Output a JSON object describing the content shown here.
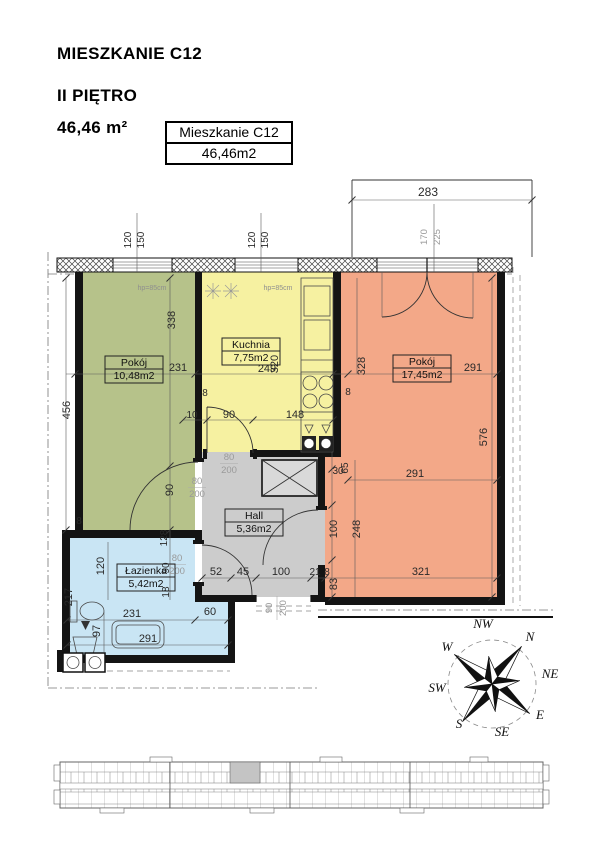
{
  "header": {
    "title": "MIESZKANIE C12",
    "floor": "II PIĘTRO",
    "area": "46,46 m²"
  },
  "label_box": {
    "name": "Mieszkanie C12",
    "area": "46,46m2"
  },
  "rooms": {
    "green": {
      "name": "Pokój",
      "area": "10,48m2"
    },
    "kitchen": {
      "name": "Kuchnia",
      "area": "7,75m2"
    },
    "living": {
      "name": "Pokój",
      "area": "17,45m2"
    },
    "hall": {
      "name": "Hall",
      "area": "5,36m2"
    },
    "bath": {
      "name": "Łazienka",
      "area": "5,42m2"
    }
  },
  "colors": {
    "green": "#b6c28a",
    "kitchen": "#f6f1a1",
    "living": "#f3a888",
    "hall": "#cccccc",
    "bath": "#c9e5f4"
  },
  "dims": {
    "d283": "283",
    "d170": "170",
    "d225": "225",
    "d120": "120",
    "d150": "150",
    "hp": "hp=85cm",
    "g338": "338",
    "g231": "231",
    "g456": "456",
    "g8": "8",
    "gdoor90": "90",
    "c128": "128",
    "c90": "90",
    "c18": "18",
    "k249": "249",
    "k320": "320",
    "k8": "8",
    "k10": "10",
    "k90": "90",
    "k148": "148",
    "o328": "328",
    "o8": "8",
    "o291a": "291",
    "o291b": "291",
    "o576": "576",
    "o30": "30",
    "o65": "65",
    "o100": "100",
    "o248": "248",
    "o83": "83",
    "o21": "21",
    "o8b": "8",
    "o321": "321",
    "h52": "52",
    "h45": "45",
    "h100": "100",
    "b120": "120",
    "b217": "217",
    "b97": "97",
    "b231": "231",
    "b60": "60",
    "b291": "291",
    "door80": "80",
    "door200": "200",
    "entry90": "90",
    "entry200": "200"
  },
  "compass": {
    "n": "N",
    "ne": "NE",
    "e": "E",
    "se": "SE",
    "s": "S",
    "sw": "SW",
    "w": "W",
    "nw": "NW"
  }
}
